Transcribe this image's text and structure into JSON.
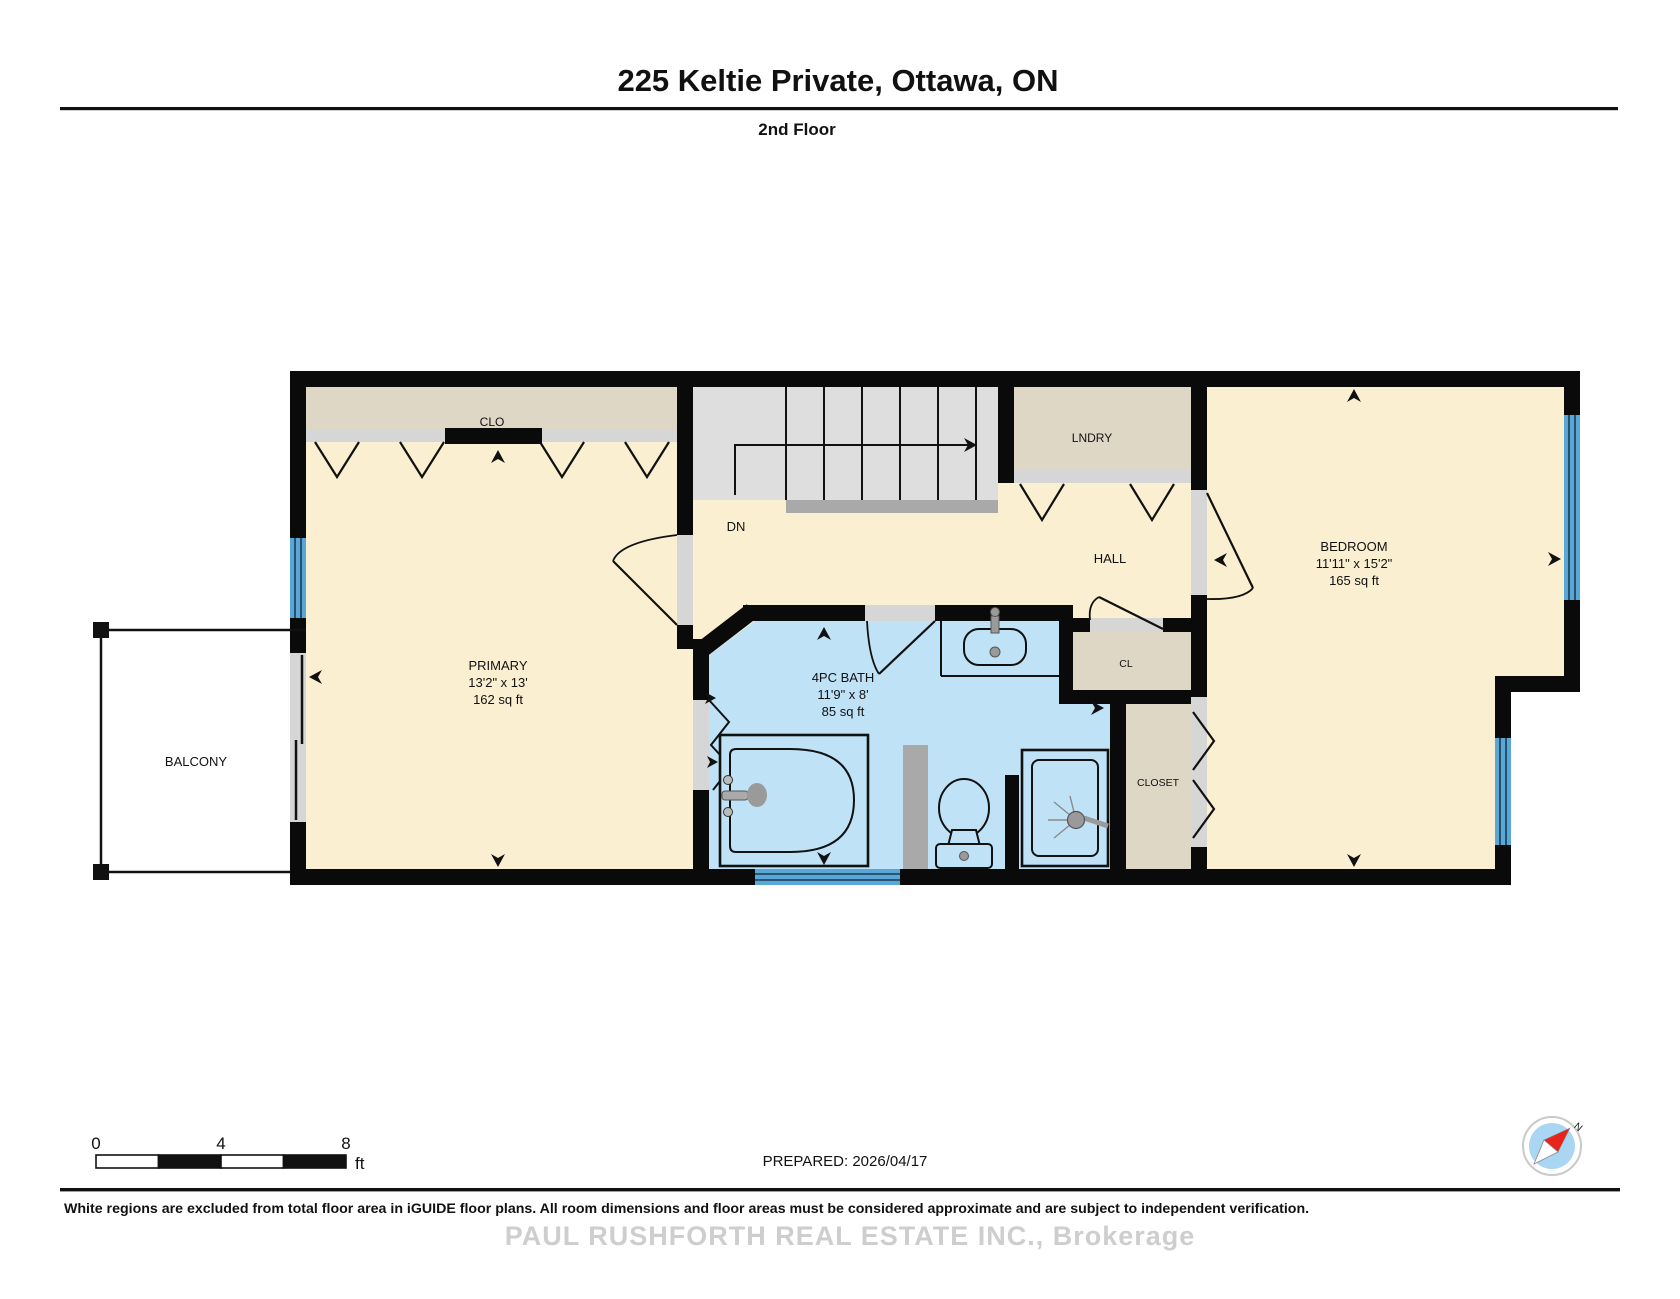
{
  "header": {
    "title": "225 Keltie Private, Ottawa, ON",
    "floor_label": "2nd Floor"
  },
  "rooms": {
    "primary": {
      "name": "PRIMARY",
      "dimensions": "13'2\" x 13'",
      "area": "162 sq ft"
    },
    "bedroom": {
      "name": "BEDROOM",
      "dimensions": "11'11\" x 15'2\"",
      "area": "165 sq ft"
    },
    "bath": {
      "name": "4PC BATH",
      "dimensions": "11'9\" x 8'",
      "area": "85 sq ft"
    },
    "hall": {
      "name": "HALL"
    },
    "laundry": {
      "name": "LNDRY"
    },
    "clo": {
      "name": "CLO"
    },
    "cl": {
      "name": "CL"
    },
    "closet": {
      "name": "CLOSET"
    },
    "balcony": {
      "name": "BALCONY"
    },
    "stairs": {
      "name": "DN"
    }
  },
  "scale_bar": {
    "tick_0": "0",
    "tick_4": "4",
    "tick_8": "8",
    "unit": "ft"
  },
  "prepared": "PREPARED: 2026/04/17",
  "compass": {
    "north_label": "N"
  },
  "footer": {
    "disclaimer": "White regions are excluded from total floor area in iGUIDE floor plans. All room dimensions and floor areas must be considered approximate and are subject to independent verification.",
    "watermark": "PAUL RUSHFORTH REAL ESTATE INC., Brokerage"
  },
  "colors": {
    "wall": "#0a0a0a",
    "floor_cream": "#faefd1",
    "closet_beige": "#ded7c6",
    "bath_blue": "#bfe2f6",
    "window_blue": "#58a7d6",
    "stairs_gray": "#dedede",
    "landing_gray": "#a9a9a9",
    "door_gray": "#d6d6d6",
    "compass_red": "#e8231a",
    "compass_blue": "#a9d6f2"
  }
}
